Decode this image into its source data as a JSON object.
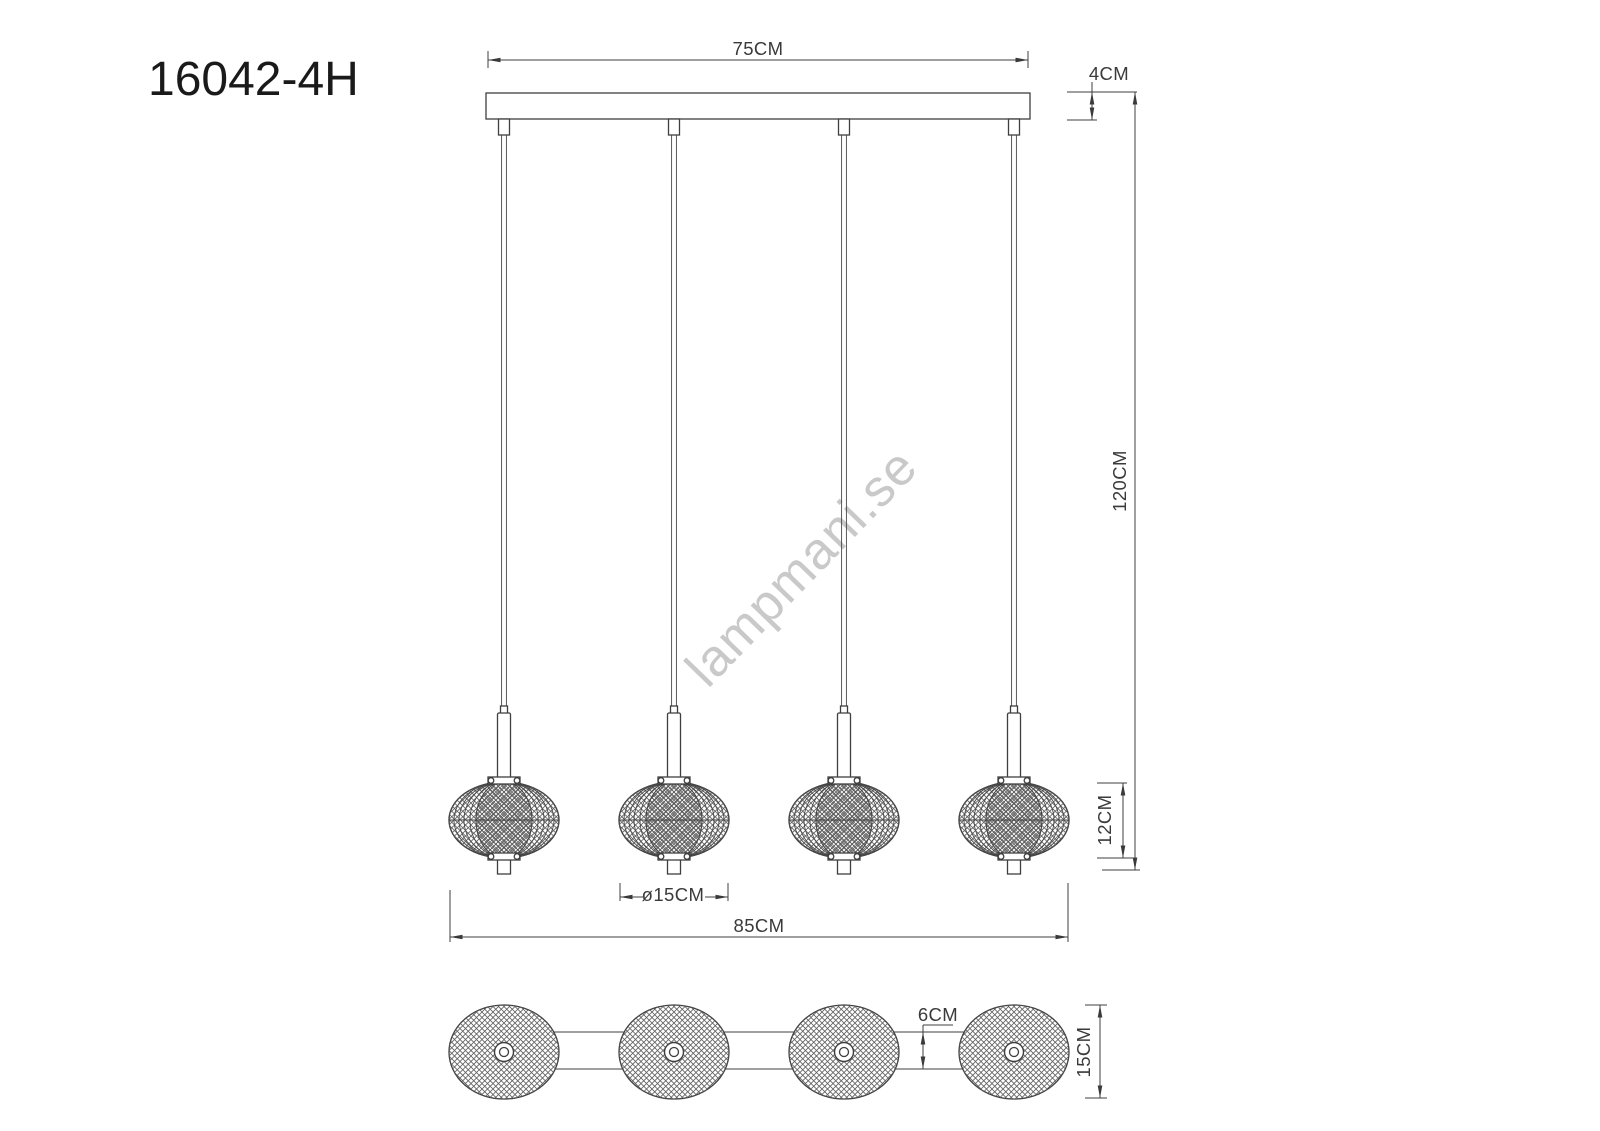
{
  "title": "16042-4H",
  "watermark": "lampmani.se",
  "views": {
    "front": {
      "pendant_count": 4,
      "dimensions": {
        "canopy_width": "75CM",
        "canopy_height": "4CM",
        "suspension_height": "120CM",
        "shade_height": "12CM",
        "shade_diameter": "ø15CM",
        "overall_width": "85CM"
      }
    },
    "bottom": {
      "shade_count": 4,
      "dimensions": {
        "rail_depth": "6CM",
        "shade_diameter": "15CM"
      }
    }
  },
  "colors": {
    "line": "#3f3f3f",
    "dimension_text": "#3a3a3a",
    "title_text": "#1a1a1a",
    "watermark": "#c9c9c9",
    "background": "#ffffff"
  }
}
